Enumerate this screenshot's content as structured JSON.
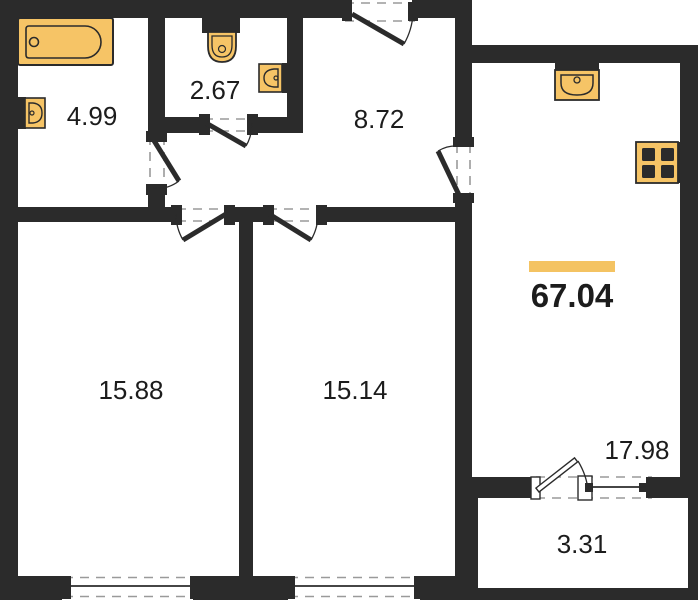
{
  "type": "apartment-floor-plan",
  "total": {
    "area": "67.04"
  },
  "rooms": [
    {
      "name": "bathroom",
      "area": "4.99"
    },
    {
      "name": "wc",
      "area": "2.67"
    },
    {
      "name": "hallway",
      "area": "8.72"
    },
    {
      "name": "room-left",
      "area": "15.88"
    },
    {
      "name": "room-middle",
      "area": "15.14"
    },
    {
      "name": "kitchen-living-room",
      "area": "17.98"
    },
    {
      "name": "balcony",
      "area": "3.31"
    }
  ],
  "fixtures": [
    "bathtub",
    "wall-sink",
    "toilet",
    "wc-sink",
    "kitchen-sink",
    "stove"
  ],
  "colors": {
    "wall": "#2b2b2b",
    "fixture_fill": "#F6C466",
    "accent_bar": "#F4C362",
    "dash": "#9a9a9a",
    "text": "#1c1c1c",
    "background": "#ffffff"
  }
}
